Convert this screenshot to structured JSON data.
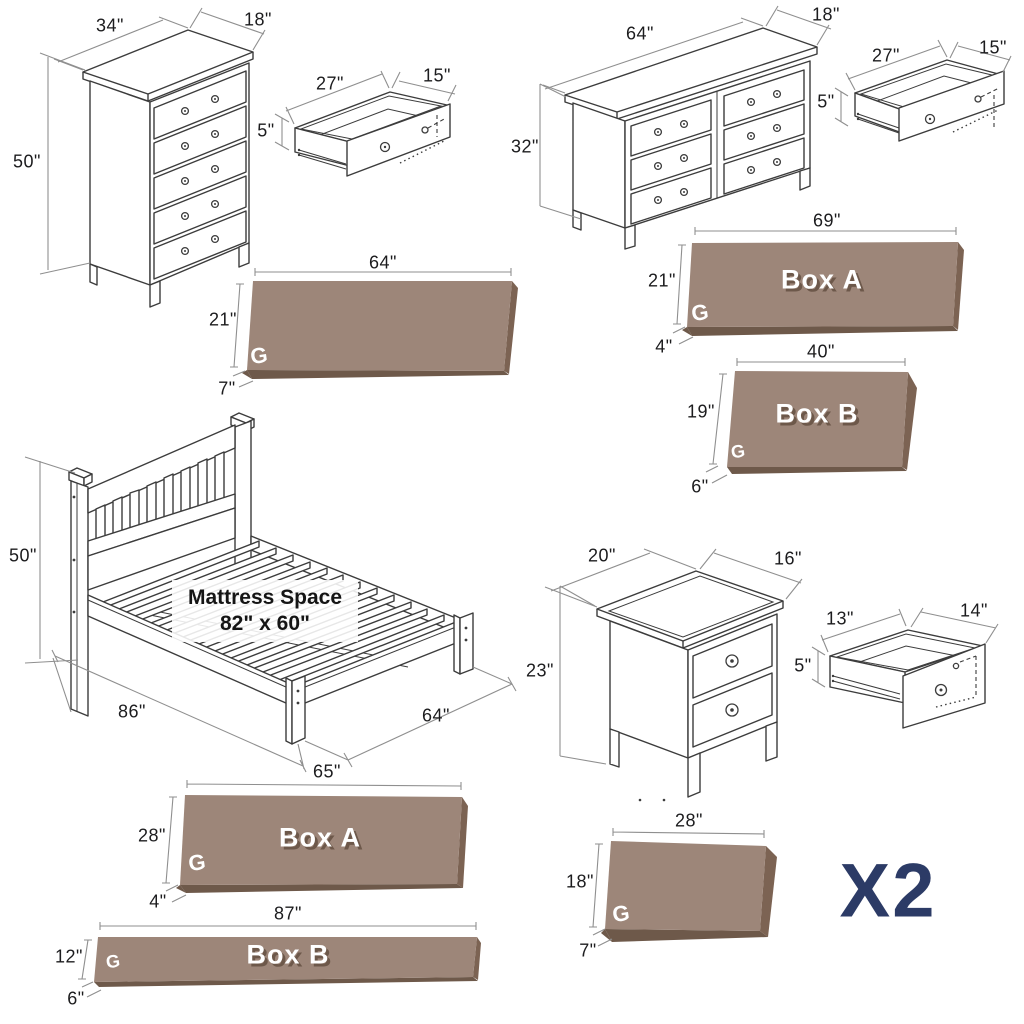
{
  "brand": {
    "logo": "G"
  },
  "quantity": {
    "label": "X2"
  },
  "chest": {
    "width": "34\"",
    "depth": "18\"",
    "height": "50\""
  },
  "chestDrawer": {
    "width": "27\"",
    "depth": "15\"",
    "height": "5\""
  },
  "dresser": {
    "width": "64\"",
    "depth": "18\"",
    "height": "32\""
  },
  "dresserDrawer": {
    "width": "27\"",
    "depth": "15\"",
    "height": "5\""
  },
  "nightstand": {
    "width": "20\"",
    "depth": "16\"",
    "height": "23\""
  },
  "nightstandDrawer": {
    "width": "13\"",
    "depth": "14\"",
    "height": "5\""
  },
  "bed": {
    "height": "50\"",
    "length": "86\"",
    "width": "64\"",
    "mattressTitle": "Mattress Space",
    "mattressSize": "82\" x 60\""
  },
  "boxes": {
    "dresserBox": {
      "length": "64\"",
      "width": "21\"",
      "height": "7\""
    },
    "boxA1": {
      "label": "Box A",
      "length": "69\"",
      "width": "21\"",
      "height": "4\""
    },
    "boxB1": {
      "label": "Box B",
      "length": "40\"",
      "width": "19\"",
      "height": "6\""
    },
    "boxA2": {
      "label": "Box A",
      "length": "65\"",
      "width": "28\"",
      "height": "4\""
    },
    "boxB2": {
      "label": "Box B",
      "length": "87\"",
      "width": "12\"",
      "height": "6\""
    },
    "nightstandBox": {
      "length": "28\"",
      "width": "18\"",
      "height": "7\""
    }
  },
  "colors": {
    "boxFace": "#9d8679",
    "boxSide": "#7c6353",
    "boxShadow": "#6e594a",
    "accent": "#2c3b66",
    "line": "#3c3c3c",
    "dim": "#8f8f8f"
  }
}
